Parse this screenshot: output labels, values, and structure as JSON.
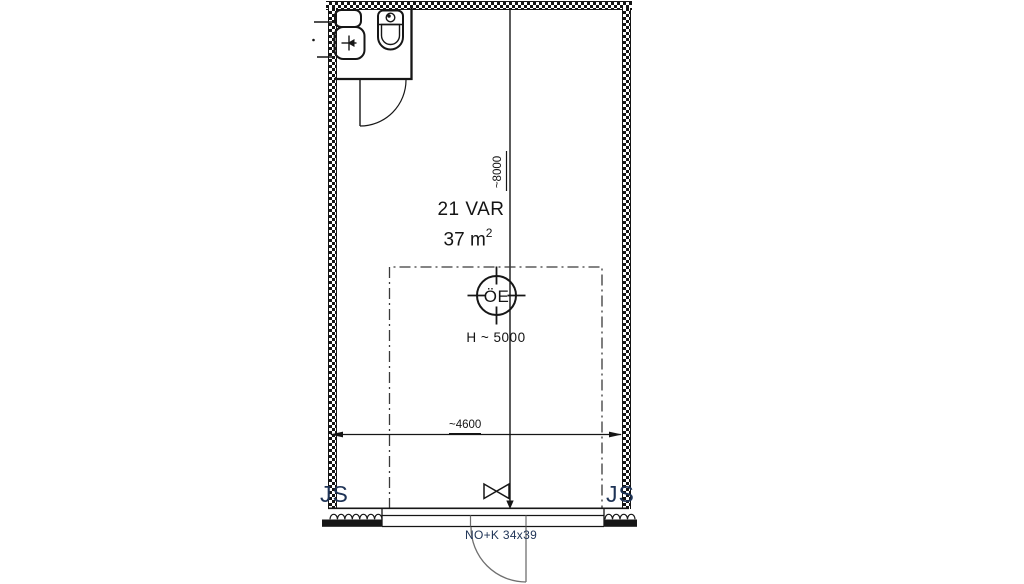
{
  "colors": {
    "line": "#161616",
    "annotation": "#1e3356",
    "dimension": "#141414",
    "door": "#6f6f6f"
  },
  "room": {
    "name": "21 VAR",
    "area": "37 m",
    "area_sup": "2"
  },
  "ceiling": {
    "symbol": "ÖE",
    "height_note": "H ~ 5000"
  },
  "dimensions": {
    "vertical": "~8000",
    "horizontal": "~4600"
  },
  "annotations": {
    "js_left": "JS",
    "js_right": "JS",
    "opening_spec": "NO+K 34x39"
  }
}
